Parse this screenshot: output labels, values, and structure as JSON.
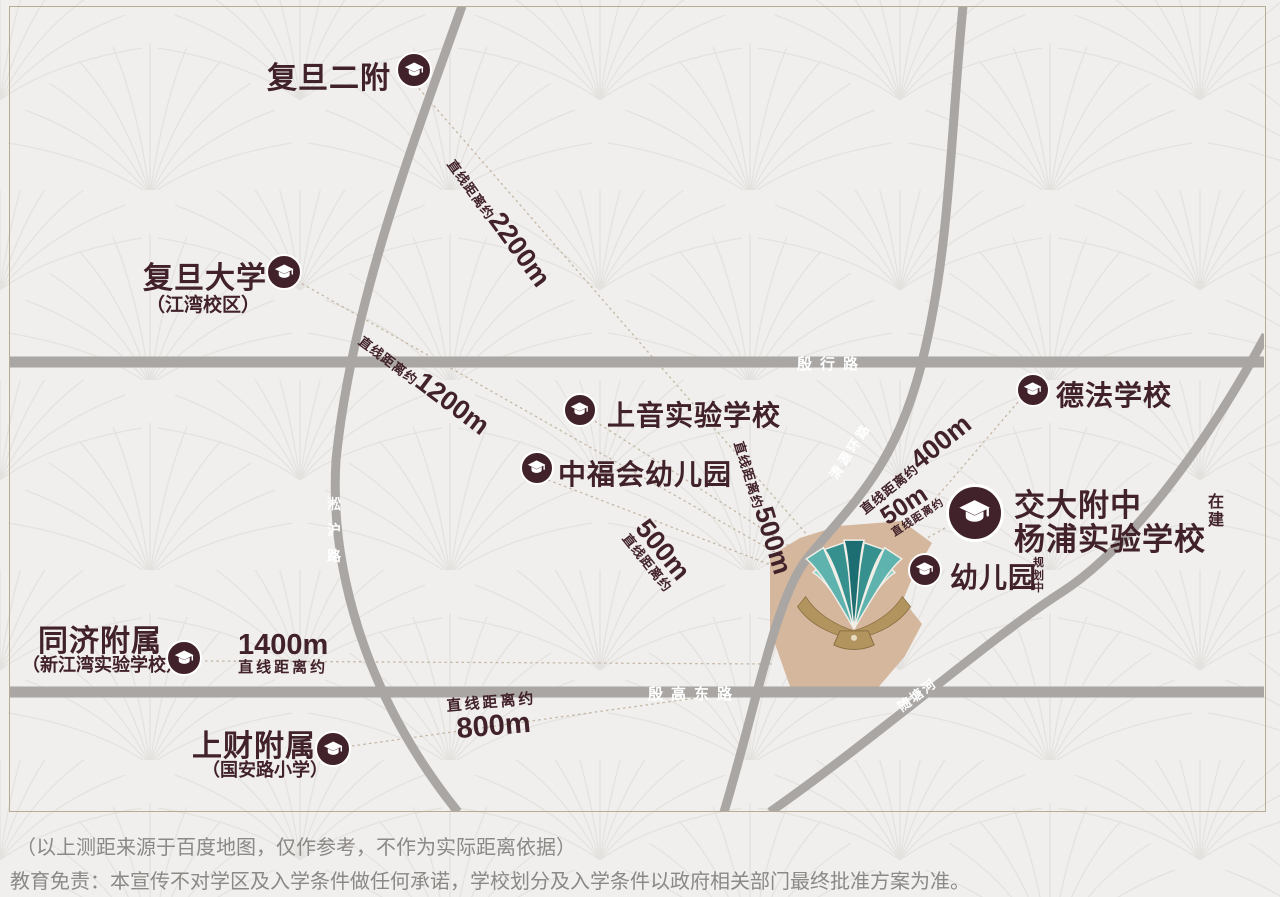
{
  "map": {
    "colors": {
      "accent_maroon": "#42222a",
      "road_gray": "#a9a6a3",
      "plot_tan": "#d5b79d",
      "building_teal": "#2e8a88",
      "building_gold": "#b2945f",
      "background": "#f0efed"
    },
    "roads": {
      "yinhang": "殷行路",
      "yingaodong": "殷高东路",
      "songhu": "淞沪路",
      "qingyuan": "清源环路",
      "suitang": "随塘河"
    },
    "schools": [
      {
        "name": "复旦二附",
        "distance_prefix": "直线距离约",
        "distance_value": "2200m"
      },
      {
        "name": "复旦大学",
        "sub": "（江湾校区）",
        "distance_prefix": "直线距离约",
        "distance_value": "1200m"
      },
      {
        "name": "上音实验学校",
        "distance_prefix": "直线距离约",
        "distance_value": "500m"
      },
      {
        "name": "中福会幼儿园",
        "distance_prefix": "直线距离约",
        "distance_value": "500m"
      },
      {
        "name": "德法学校",
        "distance_prefix": "直线距离约",
        "distance_value": "400m"
      },
      {
        "name_line1": "交大附中",
        "name_line2": "杨浦实验学校",
        "tag": "在建",
        "distance_prefix": "直线距离约",
        "distance_value": "50m"
      },
      {
        "name": "幼儿园",
        "tag": "规划中"
      },
      {
        "name": "同济附属",
        "sub": "（新江湾实验学校）",
        "distance_prefix": "直线距离约",
        "distance_value": "1400m"
      },
      {
        "name": "上财附属",
        "sub": "（国安路小学）",
        "distance_prefix": "直线距离约",
        "distance_value": "800m"
      }
    ],
    "footnote": "（以上测距来源于百度地图，仅作参考，不作为实际距离依据）",
    "disclaimer": "教育免责：本宣传不对学区及入学条件做任何承诺，学校划分及入学条件以政府相关部门最终批准方案为准。"
  }
}
